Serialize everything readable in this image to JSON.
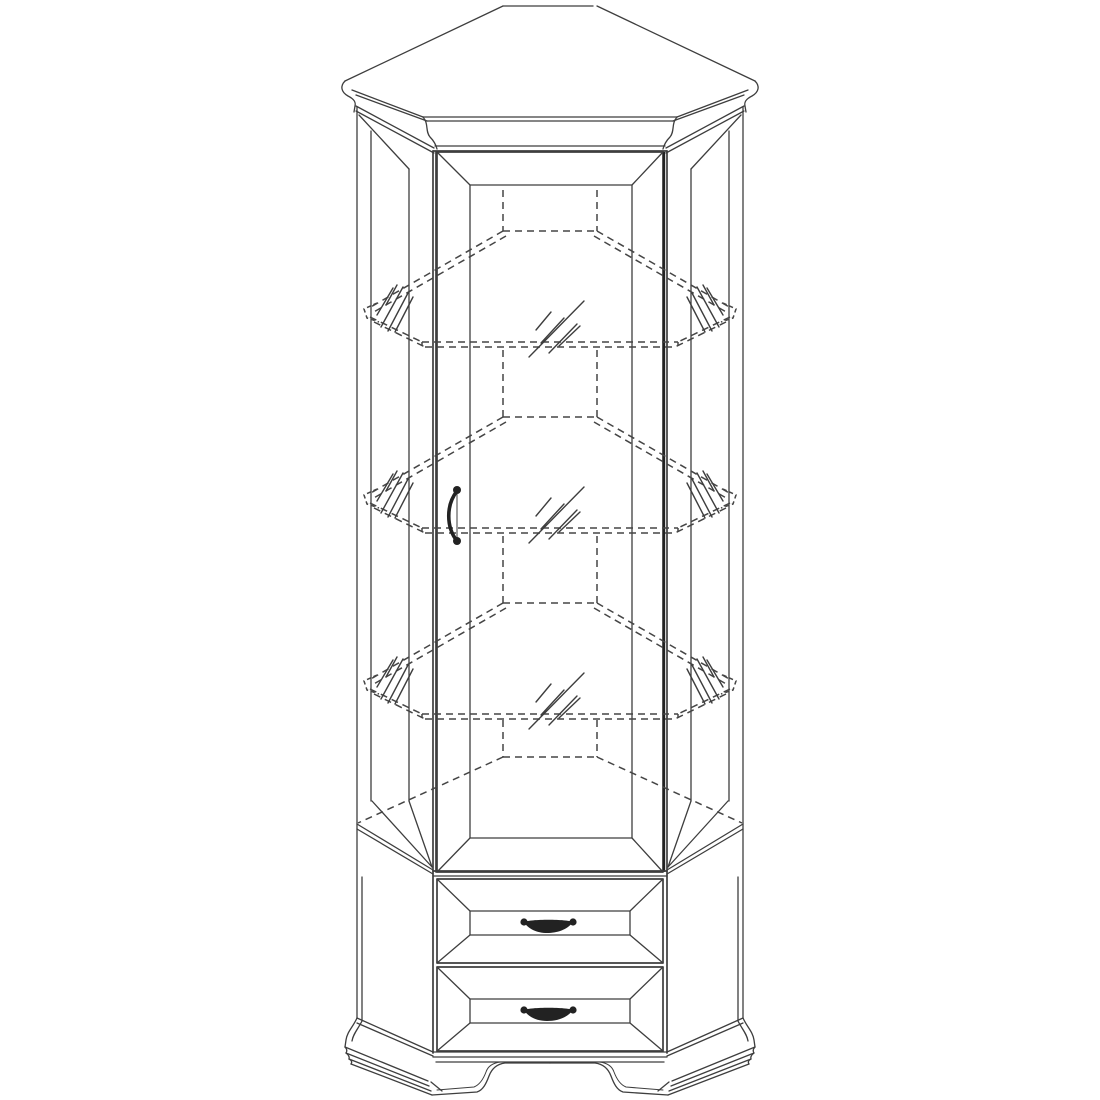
{
  "colors": {
    "background": "#ffffff",
    "line": "#3e3e3e",
    "hidden_line": "#454545",
    "emphasis": "#222222"
  },
  "drawing": {
    "subject": "corner display cabinet",
    "projection": "front elevation technical line drawing",
    "line_conventions": {
      "visible_edges": "solid",
      "hidden_and_glass_parts": "dashed",
      "glass_surfaces": "short diagonal hatch strokes"
    },
    "top": {
      "crown_molding": true,
      "top_panel_shape": "angled corner top with ogee tips left and right"
    },
    "upper_section": {
      "glazed_door": {
        "count": 1,
        "frame": "beveled rectangular frame",
        "handle": {
          "style": "vertical curved pull with ball ends",
          "position": "left stile, mid-height"
        }
      },
      "side_panels": {
        "count": 2,
        "style": "angled beveled frame panels"
      },
      "glass_shelves": {
        "count": 3,
        "shape": "pentagonal corner shelf",
        "rendering": "dashed outline with thickness, tips protruding at both sides",
        "hatch_groups_per_shelf": 3
      },
      "back_corner_posts": {
        "count": 2,
        "rendering": "dashed verticals"
      },
      "cabinet_floor": {
        "rendering": "dashed back edge with diagonals to front corners"
      }
    },
    "lower_section": {
      "drawers": {
        "count": 2,
        "front": "beveled pyramid panel",
        "handle": {
          "style": "arched bail pull with ball ends",
          "position": "centered"
        }
      }
    },
    "base": {
      "plinth_molding": true,
      "side_moldings": "angled flared moldings",
      "bracket_feet": 2,
      "apron": "arched cutout between feet"
    }
  }
}
